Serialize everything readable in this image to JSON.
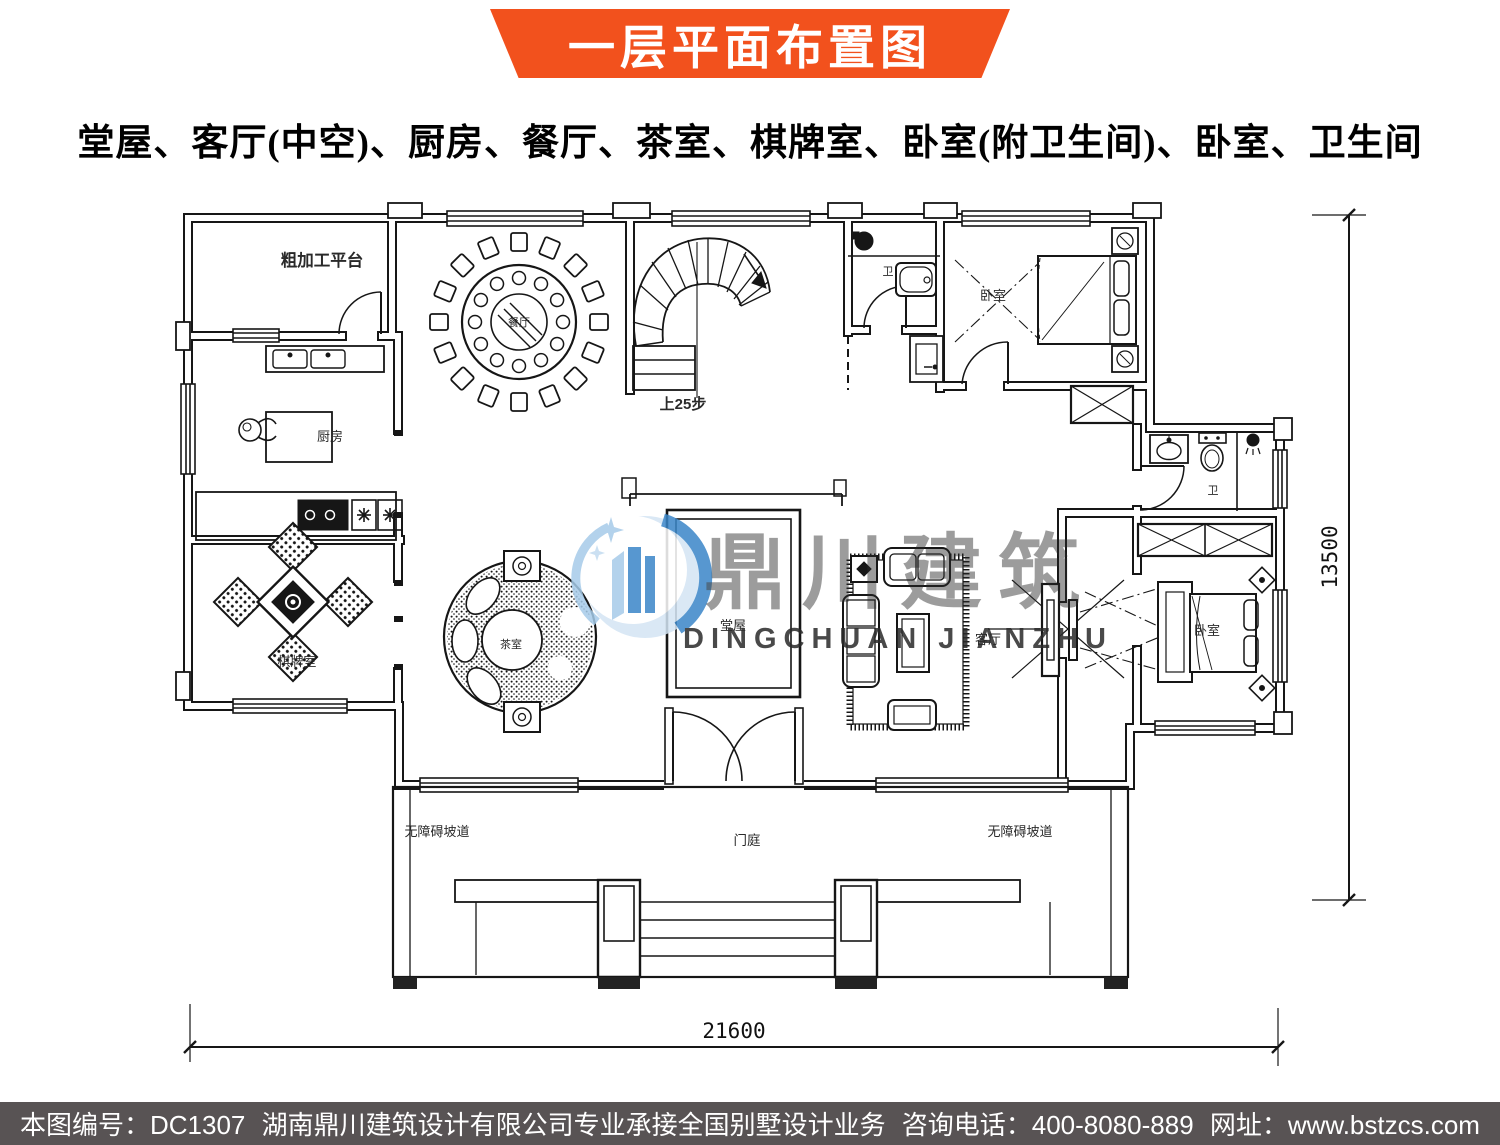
{
  "banner": {
    "title": "一层平面布置图",
    "bg_color": "#f2511d"
  },
  "subtitle": "堂屋、客厅(中空)、厨房、餐厅、茶室、棋牌室、卧室(附卫生间)、卧室、卫生间",
  "plan": {
    "labels": {
      "rough_platform": "粗加工平台",
      "kitchen": "厨房",
      "dining": "餐厅",
      "chess": "棋牌室",
      "tea": "茶室",
      "hall": "堂屋",
      "living": "客厅",
      "bedroom_top": "卧室",
      "bedroom_right": "卧室",
      "bath_top": "卫",
      "bath_right": "卫",
      "stairs": "上25步",
      "foyer": "门庭",
      "ramp_left": "无障碍坡道",
      "ramp_right": "无障碍坡道"
    },
    "dims": {
      "width": "21600",
      "height": "13500"
    }
  },
  "watermark": {
    "cn": "鼎川建筑",
    "en": "DINGCHUAN JIANZHU"
  },
  "footer": {
    "seg1": "本图编号：DC1307",
    "seg2": "湖南鼎川建筑设计有限公司专业承接全国别墅设计业务",
    "seg3": "咨询电话：400-8080-889",
    "seg4": "网址：www.bstzcs.com",
    "bg_color": "#585354"
  }
}
